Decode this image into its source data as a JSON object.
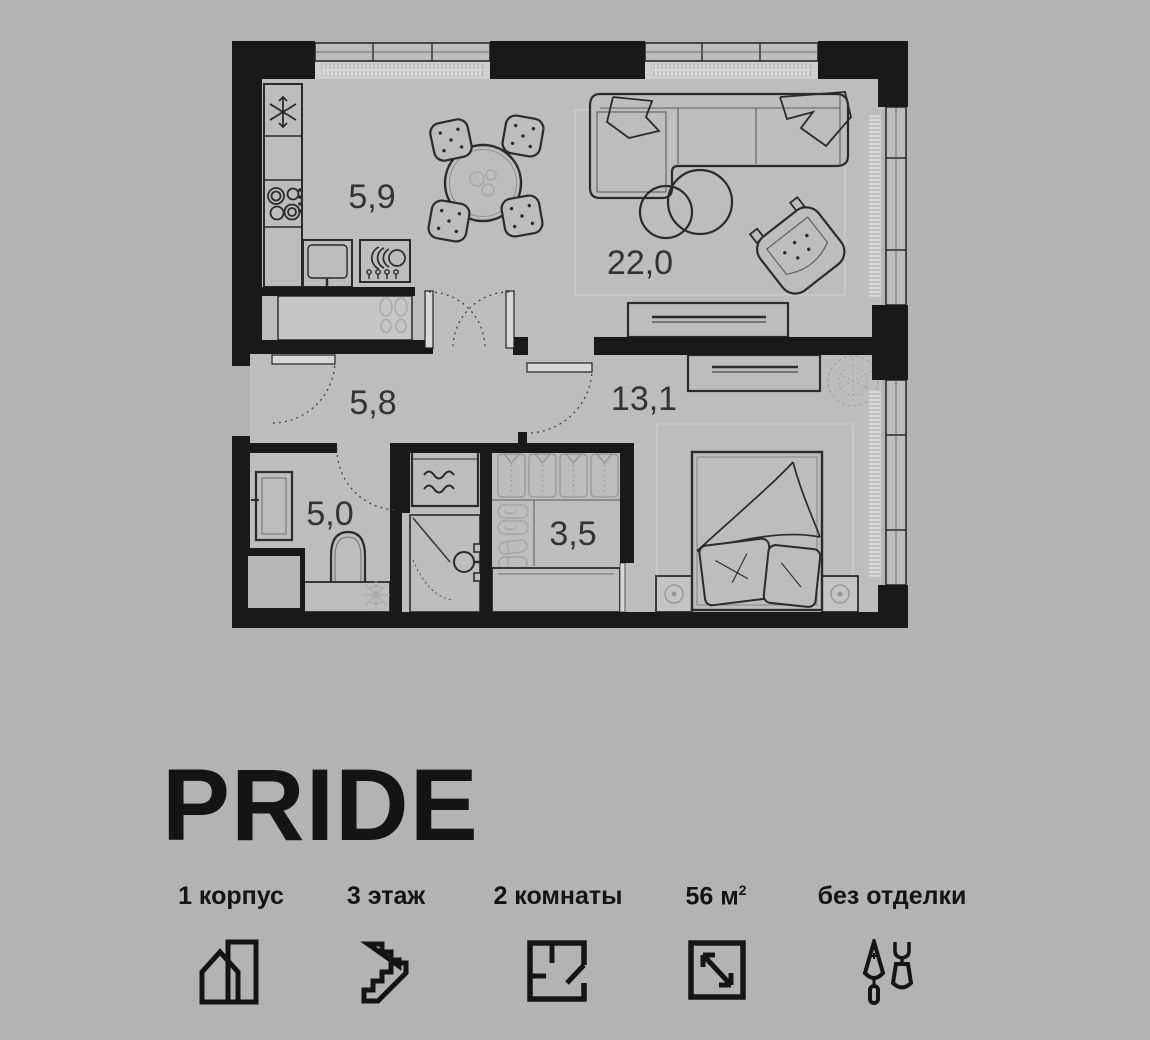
{
  "page": {
    "background": "#b3b3b3"
  },
  "brand": {
    "logo_text": "PRIDE"
  },
  "floor_plan": {
    "wall_color": "#191919",
    "floor_color": "#bdbdbd",
    "rooms": [
      {
        "name": "kitchen",
        "area": "5,9"
      },
      {
        "name": "living-room",
        "area": "22,0"
      },
      {
        "name": "hallway",
        "area": "5,8"
      },
      {
        "name": "bedroom",
        "area": "13,1"
      },
      {
        "name": "bathroom",
        "area": "5,0"
      },
      {
        "name": "wardrobe",
        "area": "3,5"
      }
    ]
  },
  "details": {
    "items": [
      {
        "id": "building",
        "label": "1 корпус",
        "icon": "building-icon"
      },
      {
        "id": "floor",
        "label": "3 этаж",
        "icon": "stairs-icon"
      },
      {
        "id": "rooms",
        "label": "2 комнаты",
        "icon": "floorplan-icon"
      },
      {
        "id": "area",
        "label": "56 м",
        "sup": "2",
        "icon": "area-icon"
      },
      {
        "id": "finishing",
        "label": "без отделки",
        "icon": "tools-icon"
      }
    ]
  }
}
